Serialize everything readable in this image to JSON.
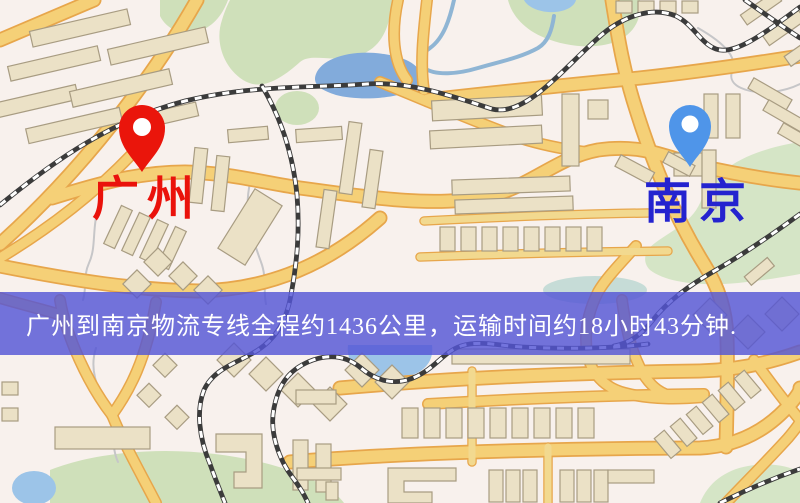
{
  "map": {
    "origin": {
      "label": "广州",
      "label_color": "#ea120b",
      "pin_color": "#ea150b",
      "pin_icon": "red-map-marker"
    },
    "destination": {
      "label": "南京",
      "label_color": "#2423cf",
      "pin_color": "#4f95e9",
      "pin_icon": "blue-map-marker"
    },
    "theme": {
      "background": "#f8f1ed",
      "road_fill": "#f5d077",
      "road_casing": "#e7a64b",
      "park": "#cfe0ba",
      "water": "#82abdb",
      "railway": "#3b3b3b"
    }
  },
  "banner": {
    "text": "广州到南京物流专线全程约1436公里，运输时间约18小时43分钟.",
    "distance_km": "1436",
    "duration_text": "18小时43分钟",
    "background_color": "#5456d6",
    "text_color": "#ffffff"
  }
}
